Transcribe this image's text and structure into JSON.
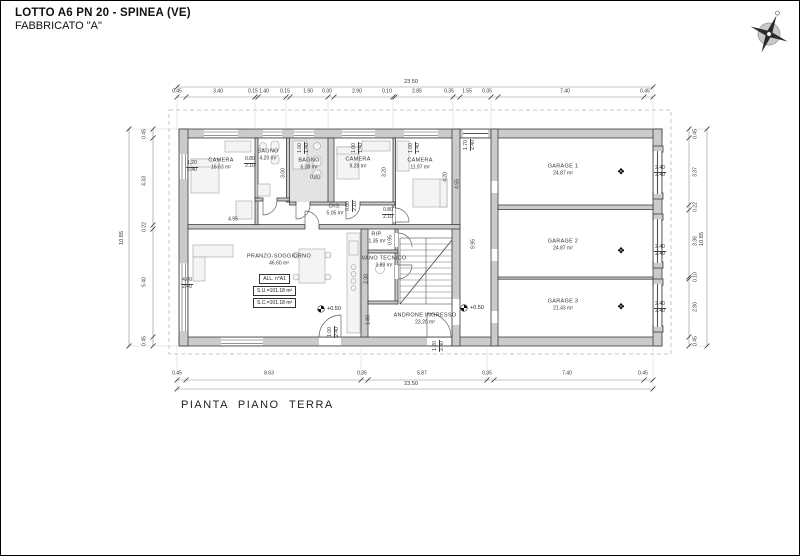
{
  "header": {
    "title": "LOTTO A6 PN 20 - SPINEA (VE)",
    "subtitle": "FABBRICATO \"A\""
  },
  "footer_label": "PIANTA PIANO TERRA",
  "rooms": [
    {
      "id": "camera-1",
      "name": "CAMERA",
      "area": "16.63 m²",
      "x": 220,
      "y": 163
    },
    {
      "id": "bagno-1",
      "name": "BAGNO",
      "area": "4.20 m²",
      "x": 267,
      "y": 154
    },
    {
      "id": "bagno-2",
      "name": "BAGNO",
      "area": "6.08 m²",
      "x": 308,
      "y": 163
    },
    {
      "id": "camera-2",
      "name": "CAMERA",
      "area": "9.28 m²",
      "x": 357,
      "y": 162
    },
    {
      "id": "camera-3",
      "name": "CAMERA",
      "area": "11.97 m²",
      "x": 419,
      "y": 163
    },
    {
      "id": "disimpegno",
      "name": "DIS.",
      "area": "5.05 m²",
      "x": 334,
      "y": 209
    },
    {
      "id": "pranzo-soggiorno",
      "name": "PRANZO-SOGGIORNO",
      "area": "46.60 m²",
      "x": 278,
      "y": 259
    },
    {
      "id": "ripostiglio",
      "name": "RIP.",
      "area": "1.35 m²",
      "x": 376,
      "y": 237
    },
    {
      "id": "vano-tecnico",
      "name": "VANO TECNICO",
      "area": "3.89 m²",
      "x": 383,
      "y": 261
    },
    {
      "id": "androne-ingresso",
      "name": "ANDRONE  INGRESSO",
      "area": "23.20 m²",
      "x": 424,
      "y": 318
    },
    {
      "id": "garage-1",
      "name": "GARAGE 1",
      "area": "24.87 m²",
      "x": 562,
      "y": 169
    },
    {
      "id": "garage-2",
      "name": "GARAGE 2",
      "area": "24.87 m²",
      "x": 562,
      "y": 244
    },
    {
      "id": "garage-3",
      "name": "GARAGE 3",
      "area": "21.43 m²",
      "x": 562,
      "y": 304
    }
  ],
  "info_box": {
    "rows": [
      "ALL.  n°A1",
      "S.U.=101.18 m²",
      "S.C.=101.18 m²"
    ]
  },
  "level_marks": [
    {
      "label": "+0.50"
    },
    {
      "label": "+0.50"
    }
  ],
  "symbols": {
    "garage_door": "❖"
  },
  "garage_door_symbols": [
    {
      "x": 620,
      "y": 171
    },
    {
      "x": 620,
      "y": 250
    },
    {
      "x": 620,
      "y": 306
    }
  ],
  "dimensions": {
    "top_chain": {
      "y": 91,
      "items": [
        {
          "label": "0.45",
          "x": 176
        },
        {
          "label": "3.40",
          "x": 217
        },
        {
          "label": "0.15",
          "x": 252
        },
        {
          "label": "1.40",
          "x": 263
        },
        {
          "label": "0.15",
          "x": 284
        },
        {
          "label": "1.90",
          "x": 307
        },
        {
          "label": "0.30",
          "x": 326
        },
        {
          "label": "2.90",
          "x": 356
        },
        {
          "label": "0.10",
          "x": 386
        },
        {
          "label": "2.85",
          "x": 416
        },
        {
          "label": "0.35",
          "x": 448
        },
        {
          "label": "1.55",
          "x": 466
        },
        {
          "label": "0.35",
          "x": 486
        },
        {
          "label": "7.40",
          "x": 564
        },
        {
          "label": "0.45",
          "x": 644
        }
      ]
    },
    "bottom_chain": {
      "y": 373,
      "items": [
        {
          "label": "0.45",
          "x": 176
        },
        {
          "label": "8.63",
          "x": 268
        },
        {
          "label": "0.35",
          "x": 361
        },
        {
          "label": "5.87",
          "x": 421
        },
        {
          "label": "0.35",
          "x": 486
        },
        {
          "label": "7.40",
          "x": 566
        },
        {
          "label": "0.45",
          "x": 642
        }
      ]
    },
    "left_chain": {
      "x": 144,
      "items": [
        {
          "label": "0.45",
          "y": 133
        },
        {
          "label": "4.33",
          "y": 180
        },
        {
          "label": "0.22",
          "y": 226
        },
        {
          "label": "5.40",
          "y": 281
        },
        {
          "label": "0.45",
          "y": 340
        }
      ]
    },
    "right_chain": {
      "x": 695,
      "items": [
        {
          "label": "0.45",
          "y": 133
        },
        {
          "label": "3.37",
          "y": 171
        },
        {
          "label": "0.22",
          "y": 206
        },
        {
          "label": "3.36",
          "y": 240
        },
        {
          "label": "0.10",
          "y": 276
        },
        {
          "label": "2.90",
          "y": 306
        },
        {
          "label": "0.45",
          "y": 340
        }
      ]
    },
    "totals": [
      {
        "label": "23.50",
        "x": 410,
        "y": 81,
        "rot": 0
      },
      {
        "label": "23.50",
        "x": 410,
        "y": 383,
        "rot": 0
      },
      {
        "label": "10.85",
        "x": 121,
        "y": 237,
        "rot": 1
      },
      {
        "label": "10.85",
        "x": 701,
        "y": 238,
        "rot": 1
      }
    ],
    "inner": [
      {
        "lines": [
          "1.20",
          "2.40"
        ],
        "x": 191,
        "y": 166,
        "rot": 0
      },
      {
        "lines": [
          "0.80",
          "2.10"
        ],
        "x": 249,
        "y": 162,
        "rot": 0
      },
      {
        "lines": [
          "4.95"
        ],
        "x": 232,
        "y": 219,
        "rot": 0
      },
      {
        "lines": [
          "3.00"
        ],
        "x": 283,
        "y": 172,
        "rot": 1
      },
      {
        "lines": [
          "0.80"
        ],
        "x": 314,
        "y": 177,
        "rot": 0
      },
      {
        "lines": [
          "1.00",
          "1.40"
        ],
        "x": 303,
        "y": 147,
        "rot": 1
      },
      {
        "lines": [
          "1.00",
          "1.40"
        ],
        "x": 357,
        "y": 147,
        "rot": 1
      },
      {
        "lines": [
          "1.00",
          "1.40"
        ],
        "x": 414,
        "y": 147,
        "rot": 1
      },
      {
        "lines": [
          "3.20"
        ],
        "x": 384,
        "y": 171,
        "rot": 1
      },
      {
        "lines": [
          "4.20"
        ],
        "x": 445,
        "y": 176,
        "rot": 1
      },
      {
        "lines": [
          "4.55"
        ],
        "x": 457,
        "y": 183,
        "rot": 1
      },
      {
        "lines": [
          "0.80",
          "2.10"
        ],
        "x": 351,
        "y": 205,
        "rot": 1
      },
      {
        "lines": [
          "0.80",
          "2.10"
        ],
        "x": 387,
        "y": 213,
        "rot": 0
      },
      {
        "lines": [
          "0.95"
        ],
        "x": 390,
        "y": 239,
        "rot": 1
      },
      {
        "lines": [
          "2.30"
        ],
        "x": 366,
        "y": 278,
        "rot": 1
      },
      {
        "lines": [
          "1.80"
        ],
        "x": 368,
        "y": 319,
        "rot": 1
      },
      {
        "lines": [
          "4.00",
          "2.40"
        ],
        "x": 186,
        "y": 283,
        "rot": 0
      },
      {
        "lines": [
          "1.00",
          "2.40"
        ],
        "x": 333,
        "y": 331,
        "rot": 1
      },
      {
        "lines": [
          "1.20",
          "2.40"
        ],
        "x": 438,
        "y": 345,
        "rot": 1
      },
      {
        "lines": [
          "1.70",
          "2.40"
        ],
        "x": 469,
        "y": 144,
        "rot": 1
      },
      {
        "lines": [
          "9.95"
        ],
        "x": 473,
        "y": 243,
        "rot": 1
      },
      {
        "lines": [
          "2.40",
          "2.40"
        ],
        "x": 659,
        "y": 171,
        "rot": 0
      },
      {
        "lines": [
          "2.40",
          "2.40"
        ],
        "x": 659,
        "y": 250,
        "rot": 0
      },
      {
        "lines": [
          "2.40",
          "2.40"
        ],
        "x": 659,
        "y": 307,
        "rot": 0
      }
    ]
  }
}
